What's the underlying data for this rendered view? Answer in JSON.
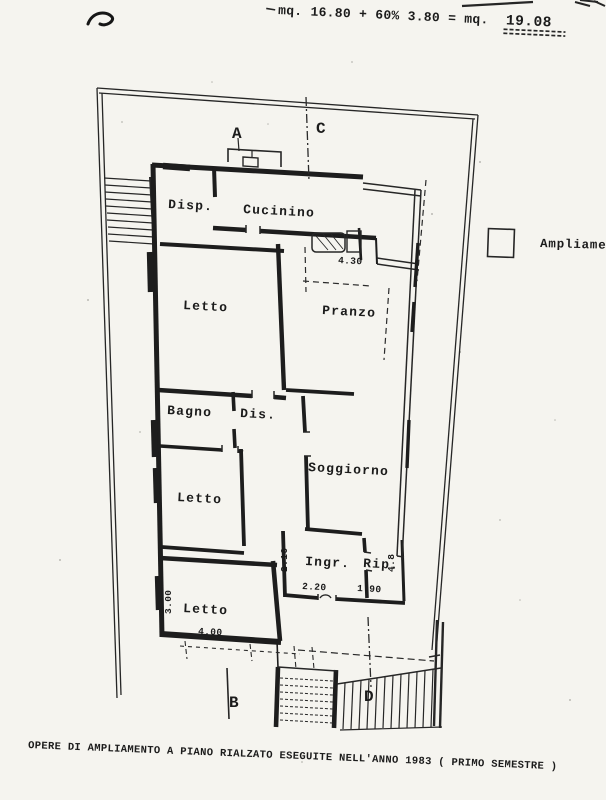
{
  "colors": {
    "paper": "#f5f4ef",
    "ink": "#1d1d1d"
  },
  "header": {
    "formula_left": "mq. 16.80 + 60% 3.80 = mq.",
    "formula_result": "19.08"
  },
  "legend": {
    "label": "Ampliamen"
  },
  "plan": {
    "rooms": [
      {
        "name": "Disp."
      },
      {
        "name": "Cucinino"
      },
      {
        "name": "Letto"
      },
      {
        "name": "Pranzo"
      },
      {
        "name": "Bagno"
      },
      {
        "name": "Dis."
      },
      {
        "name": "Soggiorno"
      },
      {
        "name": "Letto"
      },
      {
        "name": "Ingr."
      },
      {
        "name": "Rip."
      },
      {
        "name": "Letto"
      }
    ],
    "sections": [
      {
        "label": "A"
      },
      {
        "label": "B"
      },
      {
        "label": "C"
      },
      {
        "label": "D"
      }
    ],
    "dimensions": [
      {
        "value": "4.30"
      },
      {
        "value": "2.16"
      },
      {
        "value": "2.20"
      },
      {
        "value": "1.90"
      },
      {
        "value": "4.8"
      },
      {
        "value": "3.00"
      },
      {
        "value": "4.00"
      }
    ]
  },
  "footer": {
    "caption": "OPERE DI AMPLIAMENTO A PIANO RIALZATO ESEGUITE NELL'ANNO 1983 ( PRIMO SEMESTRE )"
  }
}
